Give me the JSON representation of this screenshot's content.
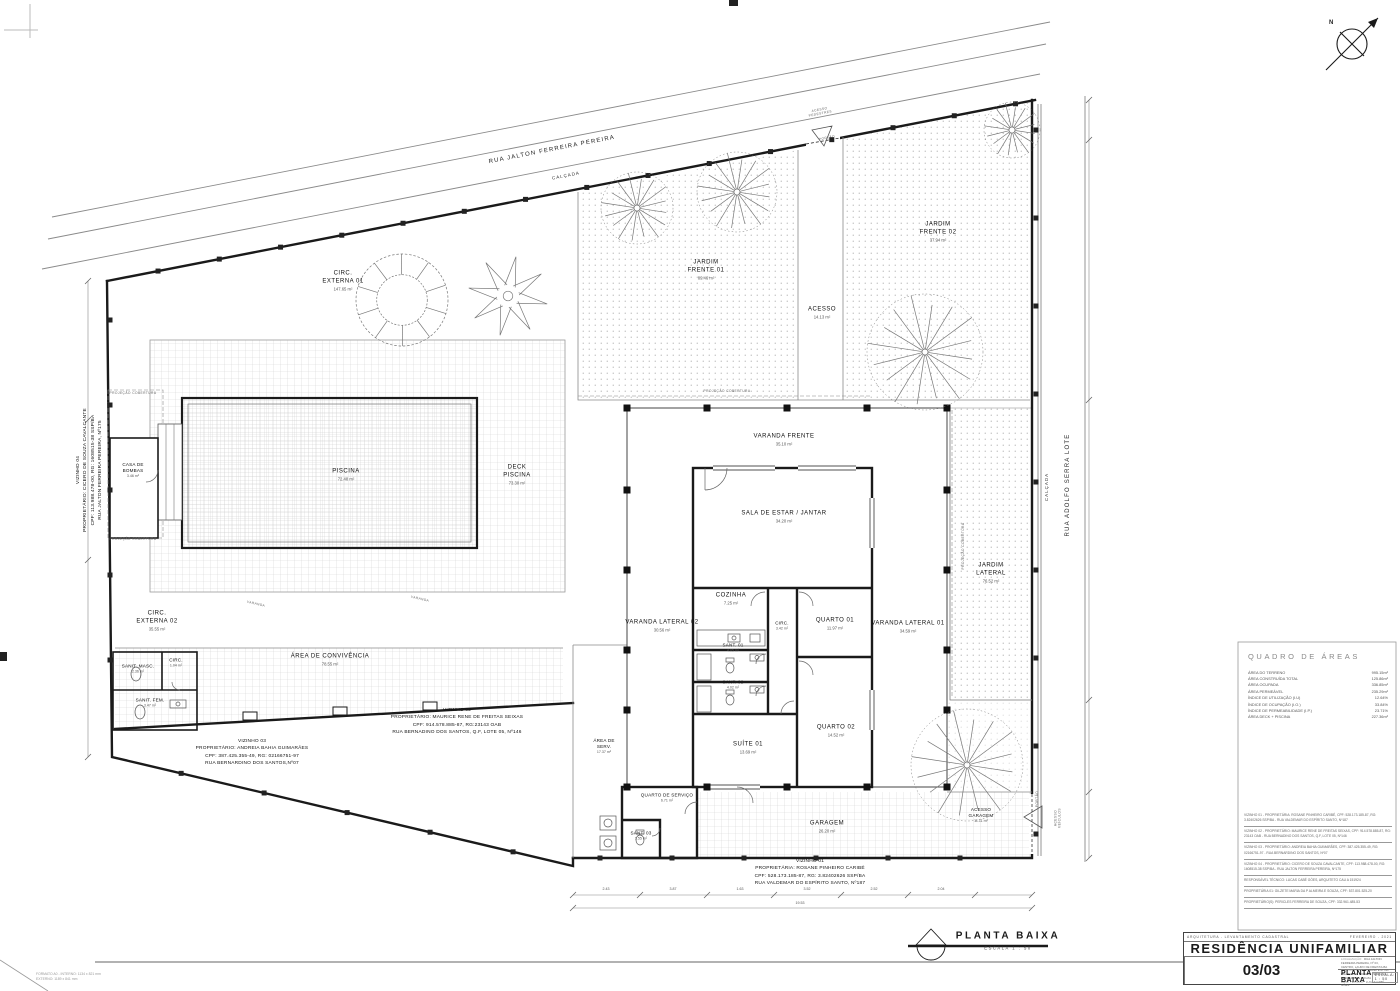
{
  "sheet": {
    "format": "FORMATO A0  -  INTERNO: 1134 x 821 mm\nEXTERNO: 1189 x 841 mm",
    "north": "N"
  },
  "streets": {
    "rua_top": "RUA JALTON FERREIRA PEREIRA",
    "calcada": "CALÇADA",
    "acesso_pedestres": "ACESSO\nPEDESTRES",
    "portao": "PORTÃO",
    "rua_right": "RUA ADOLFO SERRA LOTE",
    "acesso_veiculos": "ACESSO\nVEÍCULOS",
    "projecao": "PROJEÇÃO COBERTURA",
    "varanda": "VARANDA"
  },
  "rooms": [
    {
      "name": "CIRC.\nEXTERNA 01",
      "area": "147.65 m²"
    },
    {
      "name": "JARDIM\nFRENTE 01",
      "area": "89.46 m²"
    },
    {
      "name": "ACESSO",
      "area": "14.13 m²"
    },
    {
      "name": "JARDIM\nFRENTE 02",
      "area": "37.94 m²"
    },
    {
      "name": "CASA DE\nBOMBAS",
      "area": "3.46 m²"
    },
    {
      "name": "PISCINA",
      "area": "72.48 m²"
    },
    {
      "name": "DECK\nPISCINA",
      "area": "73.30 m²"
    },
    {
      "name": "CIRC.\nEXTERNA 02",
      "area": "35.55 m²"
    },
    {
      "name": "ÁREA DE CONVIVÊNCIA",
      "area": "78.55 m²"
    },
    {
      "name": "SANIT. MASC.",
      "area": "2.36 m²"
    },
    {
      "name": "CIRC.",
      "area": "1.04 m²"
    },
    {
      "name": "SANIT. FEM.",
      "area": "3.47 m²"
    },
    {
      "name": "VARANDA FRENTE",
      "area": "35.10 m²"
    },
    {
      "name": "SALA DE ESTAR / JANTAR",
      "area": "34.20 m²"
    },
    {
      "name": "COZINHA",
      "area": "7.25 m²"
    },
    {
      "name": "CIRC.",
      "area": "3.42 m²"
    },
    {
      "name": "QUARTO 01",
      "area": "11.97 m²"
    },
    {
      "name": "VARANDA LATERAL 01",
      "area": "34.59 m²"
    },
    {
      "name": "VARANDA LATERAL 02",
      "area": "30.56 m²"
    },
    {
      "name": "SANT. 01",
      "area": "4.05 m²"
    },
    {
      "name": "SANT. 02",
      "area": "4.02 m²"
    },
    {
      "name": "SUÍTE 01",
      "area": "13.69 m²"
    },
    {
      "name": "QUARTO 02",
      "area": "14.52 m²"
    },
    {
      "name": "JARDIM\nLATERAL",
      "area": "76.52 m²"
    },
    {
      "name": "ÁREA DE\nSERV.",
      "area": "17.37 m²"
    },
    {
      "name": "QUARTO DE SERVIÇO",
      "area": "6.71 m²"
    },
    {
      "name": "SANT. 03",
      "area": "1.55 m²"
    },
    {
      "name": "GARAGEM",
      "area": "26.20 m²"
    },
    {
      "name": "ACESSO\nGARAGEM",
      "area": "11.11 m²"
    }
  ],
  "neighbors": {
    "v01": "VIZINHO 01\nPROPRIETÁRIA: ROSANE PINHEIRO CARIBÉ\nCPF: 528.173.185-87, RG: 3.82402626 SSP/BA\nRUA VALDEMAR DO ESPÍRITO SANTO, Nº187",
    "v02": "VIZINHO 02\nPROPRIETÁRIO: MAURICE RENE DE FREITAS SEIXAS\nCPF: 914.578.885-87, RG:23143 OAB\nRUA BERNADINO DOS SANTOS, Q.F, LOTE 05, Nº146",
    "v03": "VIZINHO 03\nPROPRIETÁRIO: ANDREIA BAHIA GUIMARÃES\nCPF: 387.425.355-49, RG: 02166751-97\nRUA BERNARDINO DOS SANTOS,Nº07",
    "v04": "VIZINHO 04\nPROPRIETÁRIO: CICERO DE SOUZA CAVALCANTE\nCPF: 113.988.478-00, RG: 1608515-38 SSP/BA\nRUA JALTON FERREIRA PEREIRA, Nº175"
  },
  "areas_table": {
    "title": "QUADRO DE ÁREAS",
    "rows": [
      {
        "label": "ÁREA DO TERRENO",
        "value": "995.15m²"
      },
      {
        "label": "ÁREA CONSTRUÍDA TOTAL",
        "value": "125.86m²"
      },
      {
        "label": "ÁREA OCUPADA",
        "value": "336.85m²"
      },
      {
        "label": "ÁREA PERMEÁVEL",
        "value": "235.29m²"
      },
      {
        "label": "ÍNDICE DE UTILIZAÇÃO (I.U)",
        "value": "12.64%"
      },
      {
        "label": "ÍNDICE DE OCUPAÇÃO (I.O.)",
        "value": "33.84%"
      },
      {
        "label": "ÍNDICE DE PERMEABILIDADE (I.P.)",
        "value": "23.71%"
      },
      {
        "label": "ÁREA DECK + PISCINA",
        "value": "227.36m²"
      }
    ]
  },
  "notes": [
    "VIZINHO 01 - PROPRIETÁRIA: ROSANE PINHEIRO CARIBÉ, CPF: 528.173.185-87, RG: 3.82402626 SSP/BA - RUA VALDEMAR DO ESPÍRITO SANTO, Nº187",
    "VIZINHO 02 - PROPRIETÁRIO: MAURICE RENE DE FREITAS SEIXAS, CPF: 914.578.885-87, RG: 23143 OAB - RUA BERNADINO DOS SANTOS, Q.F, LOTE 05, Nº146",
    "VIZINHO 03 - PROPRIETÁRIO: ANDREIA BAHIA GUIMARÃES, CPF: 387.425.355-49, RG: 02166751-97 - RUA BERNARDINO DOS SANTOS, Nº07",
    "VIZINHO 04 - PROPRIETÁRIO: CICERO DE SOUZA CAVALCANTE, CPF: 113.988.478-00, RG: 1608515-38 SSP/BA - RUA JALTON FERREIRA PEREIRA, Nº175",
    "RESPONSÁVEL TÉCNICO: LUCAS CABÉ GÓES, ARQUITETO CAU A 151924",
    "PROPRIETÁRIA 01: GILZETE MARIA DA P  ALMEIRA E SOUZA, CPF: 537.801.525-20",
    "PROPRIETÁRIO(S): PERICLES FERREIRA DE SOUZA, CPF: 332.961.485-53"
  ],
  "dims": {
    "bottom": [
      "2.43",
      "3.87",
      "1.63",
      "3.52",
      "2.52",
      "2.04"
    ],
    "total": "19.53"
  },
  "plan_title": {
    "label": "PLANTA BAIXA",
    "scale": "ESCALA  1 : 50"
  },
  "titleblock": {
    "discipline": "ARQUITETURA - LEVANTAMENTO CADASTRAL",
    "date": "FEVEREIRO - 2021",
    "title": "RESIDÊNCIA UNIFAMILIAR",
    "loc_label": "LOCALIZAÇÃO:",
    "loc": "RUA JALTON FERREIRA PEREIRA, Nº 03, CENTRO, LAURO DE FREITAS-BA",
    "own_label": "PROPRIETÁRIOS:",
    "own": "GILZETE M. DA PALMEIRA E SOUZA E PERICLES FERREIRA DE SOUZA",
    "resp_label": "RESP. TÉCNICO:",
    "resp": "LUCAS CABÉ GÓES",
    "sheet_name": "PLANTA BAIXA",
    "scale": "ESCALA: 1 : 50",
    "number": "03/03"
  }
}
